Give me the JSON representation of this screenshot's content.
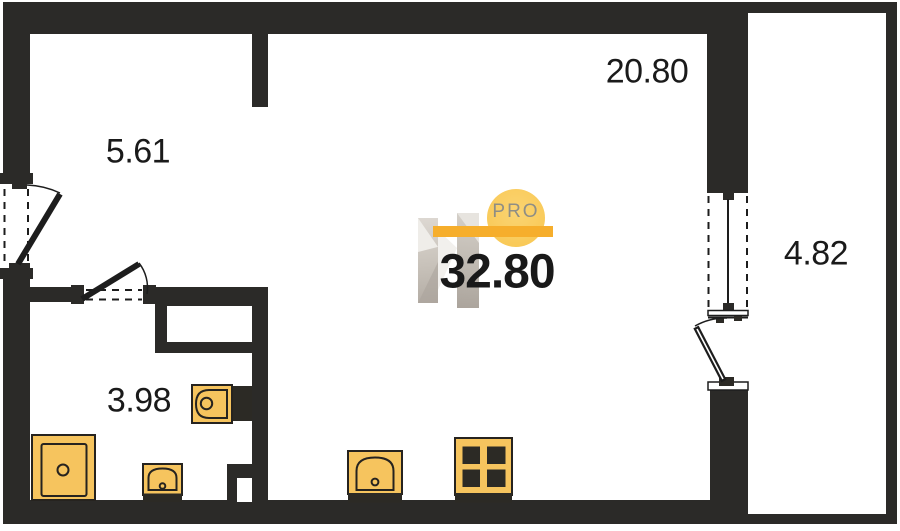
{
  "rooms": [
    {
      "name": "hallway",
      "area_label": "5.61"
    },
    {
      "name": "living-room",
      "area_label": "20.80"
    },
    {
      "name": "balcony",
      "area_label": "4.82"
    },
    {
      "name": "bathroom",
      "area_label": "3.98"
    }
  ],
  "watermark": {
    "badge_label": "PRO",
    "total_area_label": "32.80"
  },
  "fixtures": [
    "shower",
    "bathroom-sink",
    "toilet",
    "kitchen-sink",
    "stove"
  ],
  "colors": {
    "wall": "#2b2a28",
    "fixture_fill": "#f6c45e",
    "fixture_outline": "#26231f",
    "accent_bar": "#f6ae2c",
    "badge_circle": "#f9ca5c",
    "badge_text": "#8f8e85",
    "label_text": "#1a1a1a",
    "watermark_gray": "#c8c2ba"
  }
}
